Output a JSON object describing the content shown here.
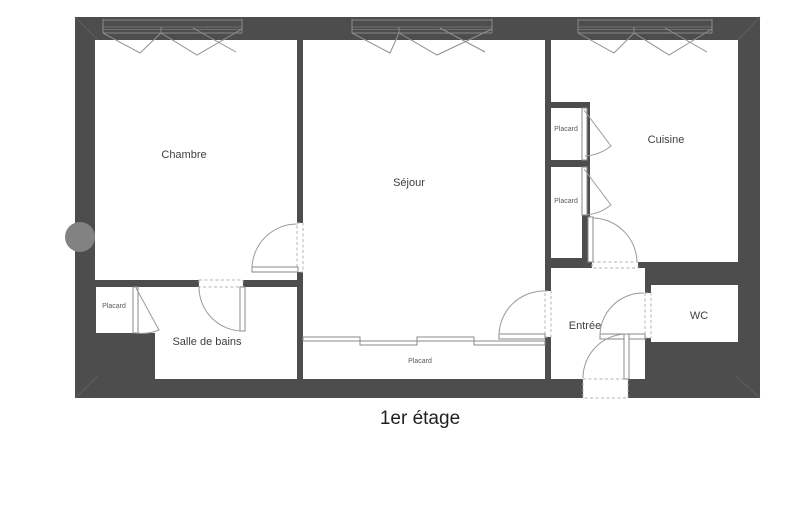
{
  "floor_plan": {
    "title": "1er étage",
    "rooms": {
      "chambre": "Chambre",
      "sejour": "Séjour",
      "cuisine": "Cuisine",
      "salle_de_bains": "Salle de bains",
      "entree": "Entrée",
      "wc": "WC"
    },
    "closets": {
      "left": "Placard",
      "column_top": "Placard",
      "column_bottom": "Placard",
      "sejour_wall": "Placard"
    },
    "colors": {
      "wall": "#4d4d4d",
      "door_line": "#9a9a9a",
      "dash_line": "#b5b5b5",
      "column_accent": "#828282",
      "label_text": "#3f3f3f",
      "title_text": "#1f1f1f",
      "background": "#ffffff"
    }
  }
}
